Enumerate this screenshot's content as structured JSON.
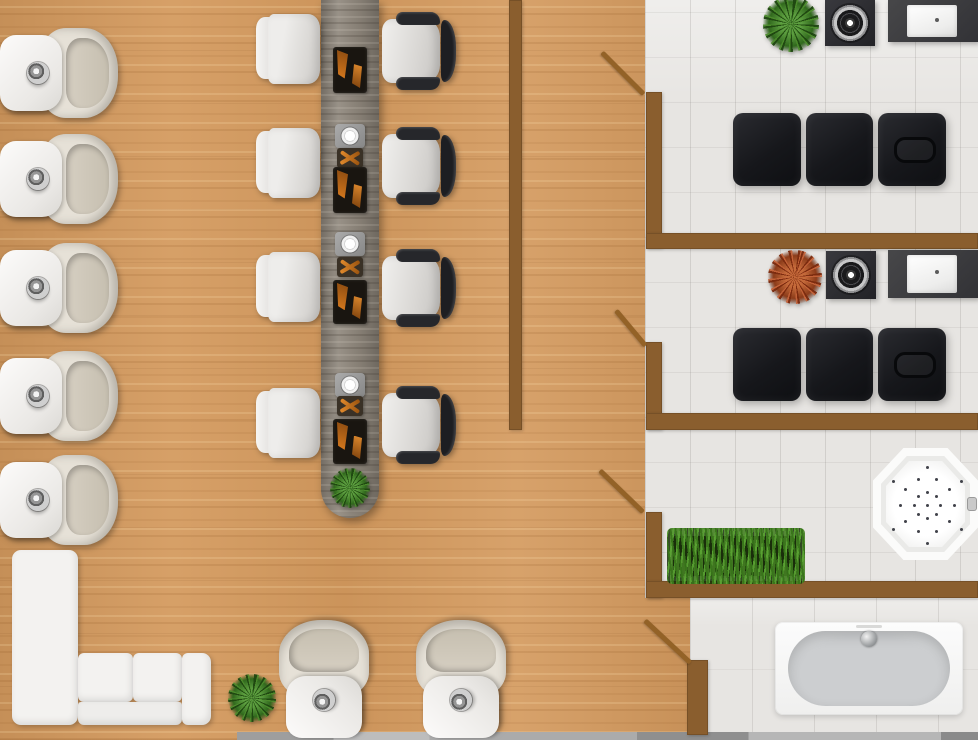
{
  "app": {
    "title": "Salon floor plan"
  },
  "palette": {
    "wood": "#d49a5e",
    "wall": "#8a5e2e",
    "door": "#936227",
    "tile": "#e7e5e2",
    "table_wood": "#8d857a",
    "leather_black": "#16171b",
    "furniture_white": "#f3f2f0",
    "bowl_beige": "#d7d1c5",
    "plant_green": "#4c8c2c",
    "plant_red": "#c46a3a",
    "grass_green": "#448022",
    "chrome": "#c9c9c9",
    "strip_gray": "#ababab"
  },
  "scene": {
    "width": 978,
    "height": 740,
    "floors": [
      {
        "name": "wood-floor",
        "kind": "wood",
        "x": 0,
        "y": 0,
        "w": 690,
        "h": 740
      },
      {
        "name": "tile-floor-rooms",
        "kind": "tile",
        "x": 645,
        "y": 0,
        "w": 333,
        "h": 598
      },
      {
        "name": "tile-floor-bath",
        "kind": "tile big",
        "x": 690,
        "y": 598,
        "w": 288,
        "h": 142
      }
    ],
    "strip": {
      "name": "bottom-edge-strip",
      "x": 237,
      "y": 732,
      "w": 741,
      "h": 8
    },
    "walls": [
      {
        "name": "wall-center-divider",
        "x": 509,
        "y": 0,
        "w": 13,
        "h": 430
      },
      {
        "name": "wall-room1-left",
        "x": 646,
        "y": 92,
        "w": 16,
        "h": 156
      },
      {
        "name": "wall-room1-room2",
        "x": 646,
        "y": 233,
        "w": 332,
        "h": 16
      },
      {
        "name": "wall-room2-left",
        "x": 646,
        "y": 342,
        "w": 16,
        "h": 88
      },
      {
        "name": "wall-room2-room3",
        "x": 646,
        "y": 413,
        "w": 332,
        "h": 17
      },
      {
        "name": "wall-room3-left",
        "x": 646,
        "y": 512,
        "w": 16,
        "h": 86
      },
      {
        "name": "wall-room3-bathroom",
        "x": 646,
        "y": 581,
        "w": 332,
        "h": 17
      },
      {
        "name": "wall-bathroom-left",
        "x": 687,
        "y": 660,
        "w": 21,
        "h": 75
      }
    ],
    "doors": [
      {
        "name": "door-room1",
        "x": 602,
        "y": 50,
        "length": 59,
        "angle": 45
      },
      {
        "name": "door-room2",
        "x": 616,
        "y": 308,
        "length": 46,
        "angle": 50
      },
      {
        "name": "door-room3",
        "x": 600,
        "y": 468,
        "length": 60,
        "angle": 44
      },
      {
        "name": "door-bathroom",
        "x": 645,
        "y": 618,
        "length": 62,
        "angle": 43
      }
    ],
    "items": [
      {
        "name": "manicure-table",
        "type": "manicure-table",
        "x": 321,
        "y": 0,
        "w": 58,
        "h": 518,
        "stations": [
          {
            "kind": "tray",
            "y": 47,
            "h": 46
          },
          {
            "kind": "bowl",
            "y": 124,
            "h": 24
          },
          {
            "kind": "tools",
            "y": 148,
            "h": 20
          },
          {
            "kind": "tray",
            "y": 167,
            "h": 46
          },
          {
            "kind": "bowl",
            "y": 232,
            "h": 24
          },
          {
            "kind": "tools",
            "y": 257,
            "h": 20
          },
          {
            "kind": "tray",
            "y": 280,
            "h": 44
          },
          {
            "kind": "bowl",
            "y": 373,
            "h": 24
          },
          {
            "kind": "tools",
            "y": 396,
            "h": 20
          },
          {
            "kind": "tray",
            "y": 419,
            "h": 45
          }
        ]
      },
      {
        "name": "table-plant",
        "type": "plant",
        "variant": "",
        "x": 330,
        "y": 468,
        "w": 40,
        "h": 40
      },
      {
        "name": "pedicure-chair-1",
        "type": "pedicure-chair",
        "x": 0,
        "y": 28,
        "w": 118,
        "h": 90
      },
      {
        "name": "pedicure-chair-2",
        "type": "pedicure-chair",
        "x": 0,
        "y": 134,
        "w": 118,
        "h": 90
      },
      {
        "name": "pedicure-chair-3",
        "type": "pedicure-chair",
        "x": 0,
        "y": 243,
        "w": 118,
        "h": 90
      },
      {
        "name": "pedicure-chair-4",
        "type": "pedicure-chair",
        "x": 0,
        "y": 351,
        "w": 118,
        "h": 90
      },
      {
        "name": "pedicure-chair-5",
        "type": "pedicure-chair",
        "x": 0,
        "y": 455,
        "w": 118,
        "h": 90
      },
      {
        "name": "pedicure-chair-6",
        "type": "pedicure-chair",
        "x": 265,
        "y": 634,
        "w": 118,
        "h": 90,
        "rot": -90
      },
      {
        "name": "pedicure-chair-7",
        "type": "pedicure-chair",
        "x": 402,
        "y": 634,
        "w": 118,
        "h": 90,
        "rot": -90
      },
      {
        "name": "side-chair-1",
        "type": "side-chair",
        "x": 256,
        "y": 14,
        "w": 64,
        "h": 70
      },
      {
        "name": "side-chair-2",
        "type": "side-chair",
        "x": 256,
        "y": 128,
        "w": 64,
        "h": 70
      },
      {
        "name": "side-chair-3",
        "type": "side-chair",
        "x": 256,
        "y": 252,
        "w": 64,
        "h": 70
      },
      {
        "name": "side-chair-4",
        "type": "side-chair",
        "x": 256,
        "y": 388,
        "w": 64,
        "h": 70
      },
      {
        "name": "office-chair-1",
        "type": "office-chair",
        "x": 380,
        "y": 12,
        "w": 76,
        "h": 78
      },
      {
        "name": "office-chair-2",
        "type": "office-chair",
        "x": 380,
        "y": 127,
        "w": 76,
        "h": 78
      },
      {
        "name": "office-chair-3",
        "type": "office-chair",
        "x": 380,
        "y": 249,
        "w": 76,
        "h": 78
      },
      {
        "name": "office-chair-4",
        "type": "office-chair",
        "x": 380,
        "y": 386,
        "w": 76,
        "h": 78
      },
      {
        "name": "room1-plant",
        "type": "plant",
        "variant": "",
        "x": 763,
        "y": -4,
        "w": 56,
        "h": 56
      },
      {
        "name": "room1-burner",
        "type": "burner",
        "x": 825,
        "y": 0,
        "w": 50,
        "h": 46
      },
      {
        "name": "room1-sink-counter",
        "type": "sink-counter",
        "x": 888,
        "y": 0,
        "w": 90,
        "h": 42
      },
      {
        "name": "massage-table-1",
        "type": "massage-table",
        "x": 733,
        "y": 113,
        "w": 213,
        "h": 73,
        "cushions": 3
      },
      {
        "name": "room2-plant",
        "type": "plant",
        "variant": "red",
        "x": 768,
        "y": 250,
        "w": 54,
        "h": 54
      },
      {
        "name": "room2-burner",
        "type": "burner",
        "x": 826,
        "y": 251,
        "w": 50,
        "h": 48
      },
      {
        "name": "room2-sink-counter",
        "type": "sink-counter",
        "x": 888,
        "y": 250,
        "w": 90,
        "h": 48
      },
      {
        "name": "massage-table-2",
        "type": "massage-table",
        "x": 733,
        "y": 328,
        "w": 213,
        "h": 73,
        "cushions": 3
      },
      {
        "name": "grass-planter",
        "type": "grass-planter",
        "x": 672,
        "y": 536,
        "w": 128,
        "h": 40
      },
      {
        "name": "jacuzzi",
        "type": "jacuzzi",
        "x": 873,
        "y": 448,
        "w": 105,
        "h": 112
      },
      {
        "name": "bathtub",
        "type": "bathtub",
        "x": 775,
        "y": 622,
        "w": 188,
        "h": 93
      },
      {
        "name": "sofa",
        "type": "sofa",
        "x": 9,
        "y": 548,
        "w": 203,
        "h": 178
      },
      {
        "name": "sofa-plant",
        "type": "plant",
        "variant": "",
        "x": 228,
        "y": 674,
        "w": 48,
        "h": 48
      }
    ]
  }
}
